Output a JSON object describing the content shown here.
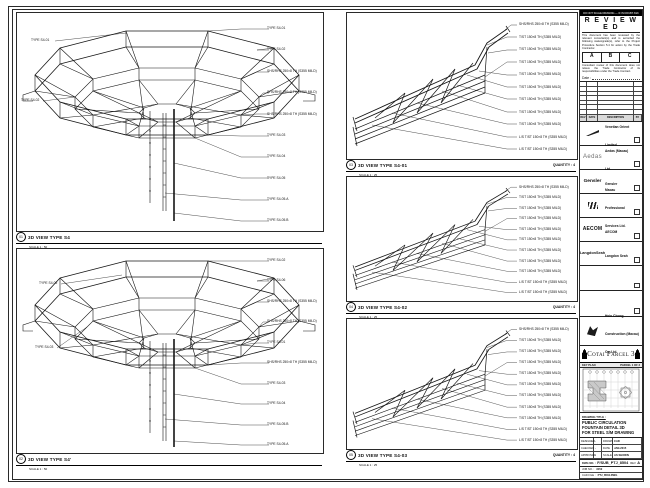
{
  "panels": {
    "tl": {
      "marker": "01",
      "title": "3D VIEW TYPE S4",
      "scale": "SCALE 1 : 50",
      "left_labels": [
        "TYPE S4-01",
        "TYPE S4-02"
      ],
      "right_labels": [
        "TYPE S4-01",
        "TYPE S4-02",
        "SHS/RHS 250×8 TH (S355 MILD)",
        "SHS/RHS 250×8 TH (S355 MILD)",
        "SHS/RHS 250×8 TH (S355 MILD)",
        "TYPE S4-03",
        "TYPE S4-04",
        "TYPE S4-05",
        "TYPE S4-05.A",
        "TYPE S4-05.B"
      ]
    },
    "bl": {
      "marker": "02",
      "title": "3D VIEW TYPE S4'",
      "scale": "SCALE 1 : 50",
      "left_labels": [
        "TYPE S4-02",
        "TYPE S4-03"
      ],
      "right_labels": [
        "TYPE S4-02",
        "TYPE S4-06",
        "SHS/RHS 250×8 TH (S355 MILD)",
        "SHS/RHS 250×8 TH (S355 MILD)",
        "TYPE S4-01",
        "SHS/RHS 250×8 TH (S355 MILD)",
        "TYPE S4-03",
        "TYPE S4-04",
        "TYPE S4-05.B",
        "TYPE S4-05.A"
      ]
    },
    "r1": {
      "marker": "03",
      "title": "3D VIEW TYPE S4-01",
      "scale": "SCALE 1 : 25",
      "quantity": "QUANTITY : 4",
      "labels": [
        "SHS/RHS 250×8 TH (S355 MILD)",
        "T/ST 150×8 TH (S355 MILD)",
        "T/ST 150×8 TH (S355 MILD)",
        "T/ST 150×8 TH (S355 MILD)",
        "T/ST 150×8 TH (S355 MILD)",
        "T/ST 150×8 TH (S355 MILD)",
        "T/ST 150×8 TH (S355 MILD)",
        "T/ST 150×8 TH (S355 MILD)",
        "T/ST 150×8 TH (S355 MILD)",
        "L/S T/ST 150×8 TH (S355 MILD)",
        "L/S T/ST 150×8 TH (S355 MILD)"
      ]
    },
    "r2": {
      "marker": "04",
      "title": "3D VIEW TYPE S4-02",
      "scale": "SCALE 1 : 25",
      "quantity": "QUANTITY : 4",
      "labels": [
        "SHS/RHS 250×8 TH (S355 MILD)",
        "T/ST 150×8 TH (S355 MILD)",
        "T/ST 150×8 TH (S355 MILD)",
        "T/ST 150×8 TH (S355 MILD)",
        "T/ST 150×8 TH (S355 MILD)",
        "T/ST 150×8 TH (S355 MILD)",
        "T/ST 150×8 TH (S355 MILD)",
        "T/ST 150×8 TH (S355 MILD)",
        "T/ST 150×8 TH (S355 MILD)",
        "L/S T/ST 150×8 TH (S355 MILD)",
        "L/S T/ST 150×8 TH (S355 MILD)"
      ]
    },
    "r3": {
      "marker": "05",
      "title": "3D VIEW TYPE S4-03",
      "scale": "SCALE 1 : 25",
      "quantity": "QUANTITY : 4",
      "labels": [
        "SHS/RHS 250×8 TH (S355 MILD)",
        "T/ST 150×8 TH (S355 MILD)",
        "T/ST 150×8 TH (S355 MILD)",
        "T/ST 150×8 TH (S355 MILD)",
        "T/ST 150×8 TH (S355 MILD)",
        "T/ST 150×8 TH (S355 MILD)",
        "T/ST 150×8 TH (S355 MILD)",
        "T/ST 150×8 TH (S355 MILD)",
        "T/ST 150×8 TH (S355 MILD)",
        "L/S T/ST 150×8 TH (S355 MILD)",
        "L/S T/ST 150×8 TH (S355 MILD)"
      ]
    }
  },
  "titleblock": {
    "top_note": "DO NOT SCALE DRAWING — IF IN DOUBT ASK",
    "reviewed": {
      "title": "R E V I E W E D",
      "note1": "This document has been reviewed by the relevant consultant(s) and is accorded the following status/grade(s), refer to the Project Procedure Section 5.4 for action by the Trade Contractor.",
      "grades": [
        "A",
        "B",
        "C"
      ],
      "note2": "Consultant review of this document does not relieve the Trade Contractor of its responsibilities under the Trade Contract.",
      "date_label": "Date :"
    },
    "revision": {
      "headers": [
        "REV",
        "DATE",
        "DESCRIPTION",
        "BY"
      ]
    },
    "consultants": [
      {
        "logo": "",
        "name": "Venetian Orient Limited"
      },
      {
        "logo": "Aedas",
        "name": "Aedas (Macau) Ltd."
      },
      {
        "logo": "Gensler",
        "name": "Gensler"
      },
      {
        "logo": "",
        "name": "Macau Professional Services Ltd."
      },
      {
        "logo": "AECOM",
        "name": "AECOM"
      },
      {
        "logo": "LangdonSeah",
        "name": "Langdon Seah"
      },
      {
        "logo": "",
        "name": ""
      },
      {
        "logo": "",
        "name": ""
      }
    ],
    "contractor": {
      "name": "Hsin Chong Construction (Macau) Co. Ltd."
    },
    "project": {
      "title": "Cotai Parcel 3"
    },
    "keyplan": {
      "label": "KEY PLAN",
      "parcel": "PARCEL 1 OF 3"
    },
    "drawing_title": {
      "label": "DRAWING TITLE :",
      "lines": [
        "PUBLIC CIRCULATION",
        "FOUNTAIN DETAIL 3D",
        "FOR STEEL S/M DRAWING"
      ]
    },
    "sign": {
      "rows": [
        [
          "DESIGNED",
          "-",
          "DRAWN",
          "CAD"
        ],
        [
          "CHECKED",
          "-",
          "DATE",
          "JAN-2015"
        ],
        [
          "APPROVED",
          "-",
          "SCALE",
          "AS SHOWN"
        ]
      ]
    },
    "dwg": {
      "no_label": "DWG NO. :",
      "no": "F/SUB_PTJ_8504",
      "rev_label": "REV",
      "rev": "A",
      "job_label": "JOB NO. :",
      "job": "3152",
      "cad_label": "CAD FILE :",
      "cad": "PTJ_8504.DWG"
    }
  }
}
